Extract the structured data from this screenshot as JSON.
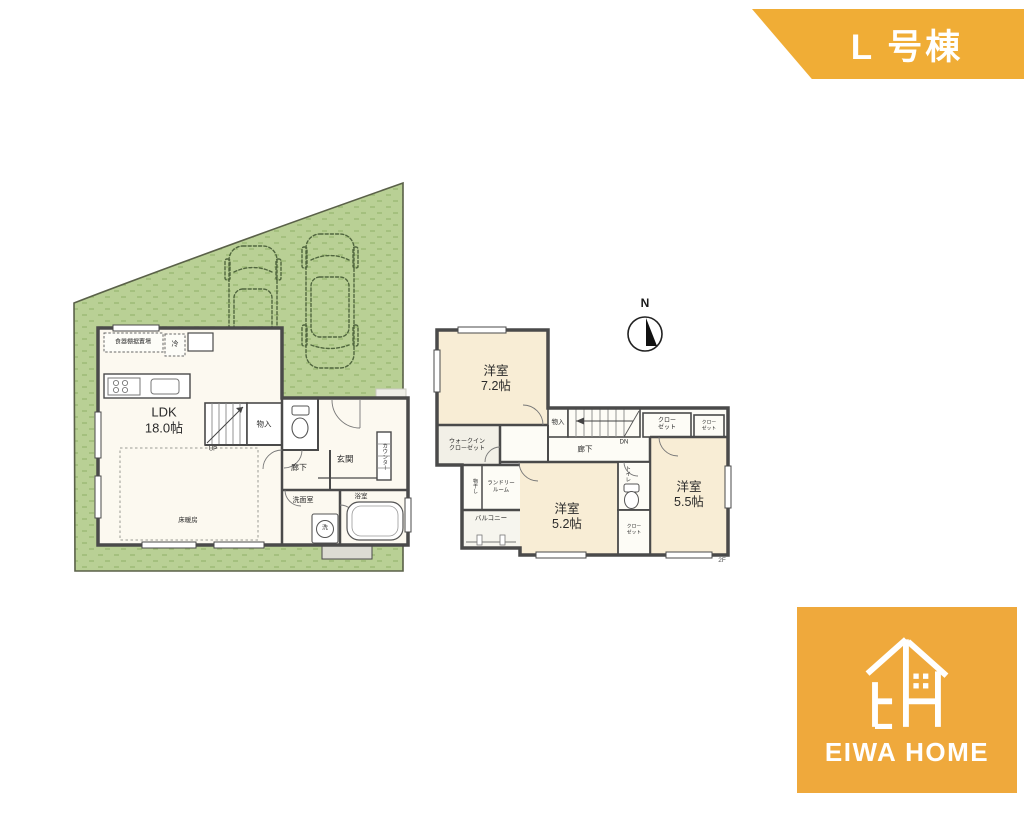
{
  "banner": {
    "label": "L 号棟",
    "color": "#F0AD36"
  },
  "north": {
    "label": "N"
  },
  "floor1": {
    "labels": {
      "dish_cabinet": "食器棚据置場",
      "fridge": "冷",
      "ldk_name": "LDK",
      "ldk_size": "18.0帖",
      "floor_heating": "床暖房",
      "up": "UP",
      "storage": "物入",
      "hallway": "廊下",
      "entrance": "玄関",
      "counter": "カウンター",
      "washroom": "洗面室",
      "washer": "洗",
      "bathroom": "浴室"
    }
  },
  "floor2": {
    "floor_tag": "2F",
    "labels": {
      "bedroom1_name": "洋室",
      "bedroom1_size": "7.2帖",
      "bedroom2_name": "洋室",
      "bedroom2_size": "5.2帖",
      "bedroom3_name": "洋室",
      "bedroom3_size": "5.5帖",
      "wic_line1": "ウォークイン",
      "wic_line2": "クローゼット",
      "storage": "物入",
      "dn": "DN",
      "hallway": "廊下",
      "closet_a_line1": "クロー",
      "closet_a_line2": "ゼット",
      "closet_b_line1": "クロー",
      "closet_b_line2": "ゼット",
      "closet_c_line1": "クロー",
      "closet_c_line2": "ゼット",
      "toilet": "トイレ",
      "laundry_line1": "ランドリー",
      "laundry_line2": "ルーム",
      "drying": "物干し",
      "balcony": "バルコニー"
    }
  },
  "logo": {
    "wordmark": "EIWA HOME",
    "color": "#EFA93C"
  },
  "colors": {
    "banner_orange": "#F0AD36",
    "logo_orange": "#EFA93C",
    "lawn_green": "#B9D095",
    "wall_gray": "#4A4A4A",
    "bedroom_cream": "#F8EDD5"
  }
}
